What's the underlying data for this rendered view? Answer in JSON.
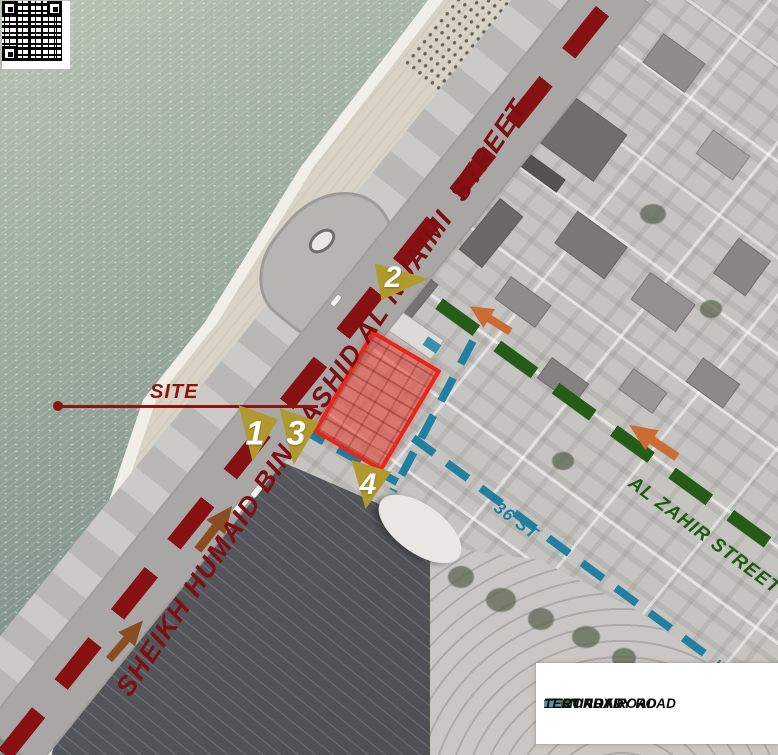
{
  "map": {
    "main_street": "SHEIKH HUMAID BIN RASHID AL NUAIMI  STREET",
    "site_callout": "SITE",
    "secondary_street": "AL ZAHIR STREET",
    "tertiary_street": "36 ST",
    "markers": [
      {
        "number": "1"
      },
      {
        "number": "2"
      },
      {
        "number": "3"
      },
      {
        "number": "4"
      }
    ]
  },
  "legend": {
    "items": [
      {
        "label": "MAIN ROAD",
        "color": "#c0281e",
        "dash_style": "large-dash"
      },
      {
        "label": "SECONDARY ROAD",
        "color": "#4c6e33",
        "dash_style": "large-dash"
      },
      {
        "label": "TERTIARY ROAD",
        "color": "#4f9ab8",
        "dash_style": "small-dash"
      }
    ]
  },
  "colors": {
    "main_road_dash": "#871112",
    "main_street_text": "#7c0f12",
    "secondary_road_dash": "#265c17",
    "secondary_street_text": "#1d5a12",
    "tertiary_road_dash": "#2180a0",
    "tertiary_street_text": "#1b7e9c",
    "site_fill": "rgba(229,57,42,0.55)",
    "site_border": "#e7251a",
    "marker_fill": "#b0992f",
    "arrow_orange": "#cb6c35",
    "arrow_brown": "#8a4d22"
  }
}
